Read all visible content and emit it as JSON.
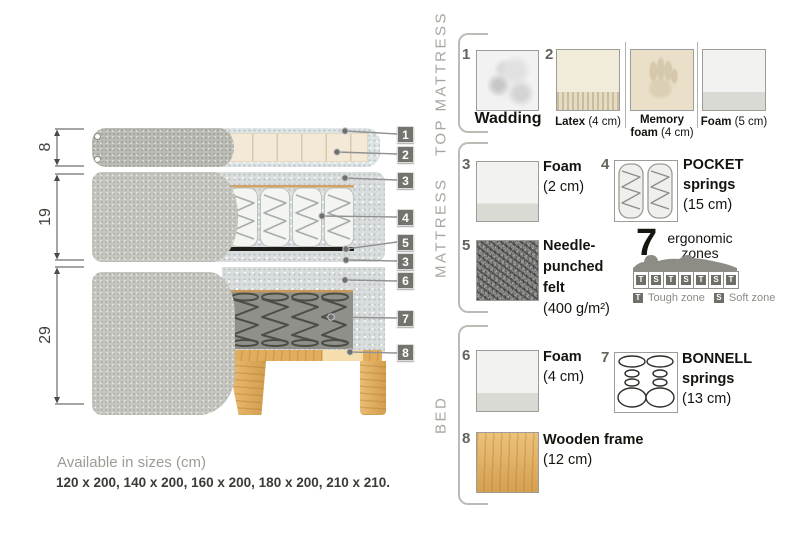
{
  "diagram": {
    "dim_top": "8",
    "dim_middle": "19",
    "dim_bottom": "29",
    "badges": {
      "b1": "1",
      "b2": "2",
      "b3": "3",
      "b4": "4",
      "b5": "5",
      "b3b": "3",
      "b6": "6",
      "b7": "7",
      "b8": "8"
    }
  },
  "sections": {
    "top_mattress": "TOP MATTRESS",
    "mattress": "MATTRESS",
    "bed": "BED"
  },
  "legend": {
    "wadding": {
      "num": "1",
      "name": "Wadding"
    },
    "layer2": {
      "num": "2",
      "latex": {
        "name": "Latex",
        "detail": "(4 cm)"
      },
      "memory": {
        "line1": "Memory",
        "line2_bold": "foam",
        "detail": "(4 cm)"
      },
      "foam": {
        "name": "Foam",
        "detail": "(5 cm)"
      }
    },
    "foam2": {
      "num": "3",
      "name": "Foam",
      "detail": "(2 cm)"
    },
    "pocket": {
      "num": "4",
      "line1": "POCKET",
      "line2": "springs",
      "detail": "(15 cm)"
    },
    "felt": {
      "num": "5",
      "line1": "Needle-",
      "line2": "punched",
      "line3": "felt",
      "detail": "(400 g/m²)"
    },
    "zones": {
      "count": "7",
      "line1": "ergonomic",
      "line2": "zones",
      "cells": [
        "T",
        "S",
        "T",
        "S",
        "T",
        "S",
        "T"
      ],
      "tough_key": "T",
      "tough_label": "Tough zone",
      "soft_key": "S",
      "soft_label": "Soft zone"
    },
    "foam4": {
      "num": "6",
      "name": "Foam",
      "detail": "(4 cm)"
    },
    "bonnell": {
      "num": "7",
      "line1": "BONNELL",
      "line2": "springs",
      "detail": "(13 cm)"
    },
    "wood": {
      "num": "8",
      "name": "Wooden frame",
      "detail": "(12 cm)"
    }
  },
  "footer": {
    "sizes_title": "Available in sizes (cm)",
    "sizes_values": "120 x 200, 140 x 200, 160 x 200, 180 x 200, 210 x 210."
  }
}
